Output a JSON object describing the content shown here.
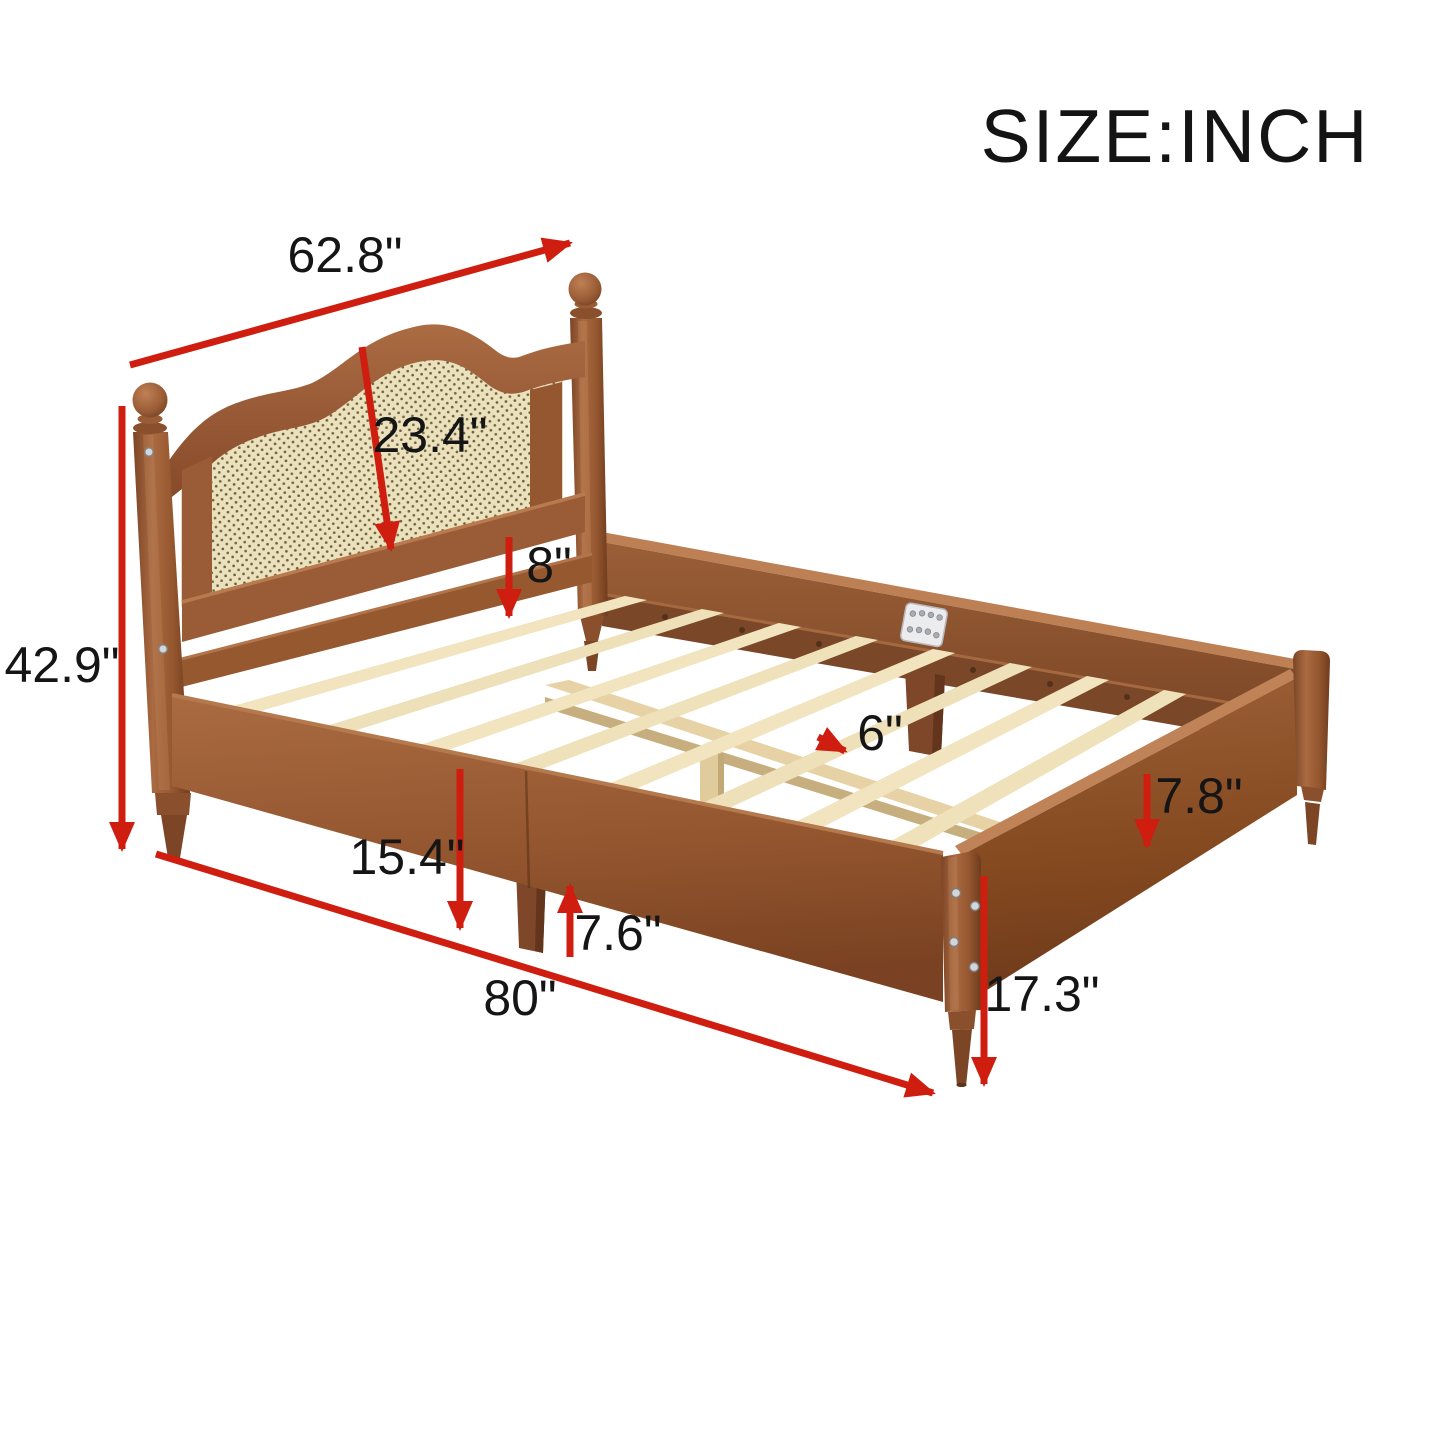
{
  "title": "SIZE:INCH",
  "unit": "INCH",
  "product": "wood platform bed frame with cane headboard",
  "colors": {
    "arrow_red": "#cf1d10",
    "label_black": "#151515",
    "wood_walnut": "#9a5c36",
    "wood_walnut_dark": "#7c4526",
    "cane_beige": "#ebe1bd",
    "slat_pine": "#f1e4bf",
    "background": "#ffffff",
    "bracket_metal": "#ececee"
  },
  "dimensions": [
    {
      "id": "headboard-width",
      "label": "62.8\""
    },
    {
      "id": "headboard-panel-height",
      "label": "23.4\""
    },
    {
      "id": "headboard-to-slat-height",
      "label": "8\""
    },
    {
      "id": "headboard-total-height",
      "label": "42.9\""
    },
    {
      "id": "side-rail-top-height",
      "label": "15.4\""
    },
    {
      "id": "center-leg-height",
      "label": "7.6\""
    },
    {
      "id": "bed-length",
      "label": "80\""
    },
    {
      "id": "slat-spacing",
      "label": "6\""
    },
    {
      "id": "foot-rail-board-height",
      "label": "7.8\""
    },
    {
      "id": "footboard-corner-height",
      "label": "17.3\""
    }
  ]
}
